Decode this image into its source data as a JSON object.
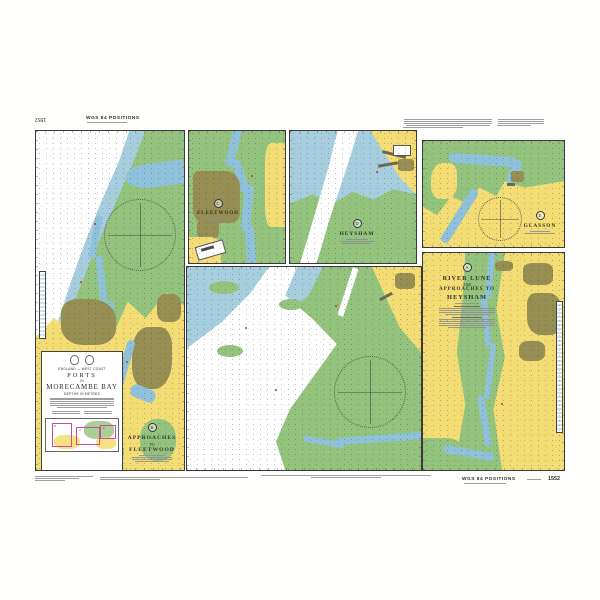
{
  "colors": {
    "land_yellow": "#f4dd74",
    "drying_green": "#94c37d",
    "shallow_blue": "#a6cede",
    "channel_blue": "#8fc2da",
    "urban_olive": "#968e52",
    "accent_red": "#cc3333",
    "magenta": "#c050a0",
    "ink": "#2f2f2f"
  },
  "marginalia": {
    "chart_number": "1552",
    "wgs_label": "WGS 84 POSITIONS"
  },
  "title_block": {
    "region": "ENGLAND — WEST COAST",
    "title_top": "PORTS",
    "title_mid": "IN",
    "title_main": "MORECAMBE BAY",
    "depths_note": "DEPTHS IN METRES"
  },
  "panels": {
    "a": {
      "letter": "A",
      "line1": "RIVER LUNE",
      "line2": "AND",
      "line3": "APPROACHES TO",
      "line4": "HEYSHAM"
    },
    "b": {
      "letter": "B",
      "line1": "APPROACHES",
      "line2": "TO",
      "line3": "FLEETWOOD"
    },
    "c": {
      "letter": "C",
      "name": "FLEETWOOD"
    },
    "d": {
      "letter": "D",
      "name": "HEYSHAM"
    },
    "e": {
      "letter": "E",
      "name": "GLASSON"
    }
  },
  "index_diagram": {
    "letters": [
      "A",
      "B",
      "C",
      "D",
      "E"
    ]
  }
}
